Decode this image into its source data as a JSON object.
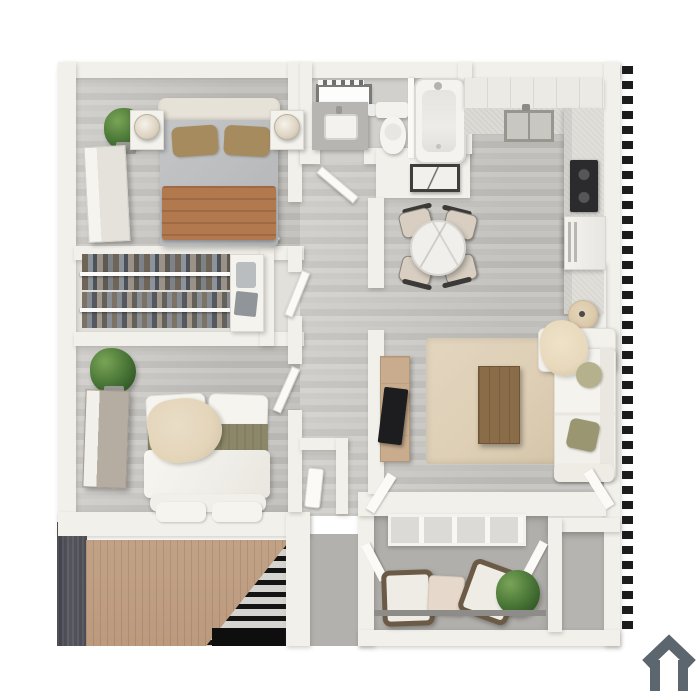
{
  "scene": {
    "kind": "3d-floorplan-top-down-render",
    "canvas": {
      "width": 700,
      "height": 700
    },
    "rooms": [
      {
        "name": "bedroom-1",
        "contents": [
          "queen-bed",
          "nightstand-left",
          "nightstand-right",
          "table-lamp-left",
          "table-lamp-right",
          "dresser",
          "potted-plant"
        ]
      },
      {
        "name": "walk-in-closet",
        "contents": [
          "hanging-clothes-rail-top",
          "hanging-clothes-rail-bottom",
          "linen-cabinet"
        ]
      },
      {
        "name": "bedroom-2",
        "contents": [
          "queen-bed",
          "dresser",
          "potted-plant",
          "foot-bench"
        ]
      },
      {
        "name": "bathroom",
        "contents": [
          "vanity-mirror-lights",
          "vanity-sink",
          "toilet",
          "bathtub-shower"
        ]
      },
      {
        "name": "kitchen",
        "contents": [
          "upper-cabinets",
          "kitchen-sink",
          "cooktop",
          "refrigerator",
          "counters"
        ]
      },
      {
        "name": "dining-area",
        "contents": [
          "round-marble-table",
          "dining-chair x4",
          "wall-art",
          "floor-lamp"
        ]
      },
      {
        "name": "living-room",
        "contents": [
          "area-rug",
          "coffee-table",
          "tv-console",
          "tv",
          "sectional-sofa",
          "throw-blanket",
          "pillows"
        ]
      },
      {
        "name": "hallway",
        "contents": [
          "entry-closet",
          "doors"
        ]
      },
      {
        "name": "patio",
        "contents": [
          "sliding-glass-door",
          "patio-chair x2",
          "side-table",
          "bush-plant"
        ]
      },
      {
        "name": "storage-room",
        "contents": []
      },
      {
        "name": "exterior",
        "contents": [
          "staircase",
          "hatch-marks-left",
          "hatch-marks-right"
        ]
      }
    ]
  },
  "palette": {
    "wall": "#f2f0ea",
    "wall-shade": "#dedad2",
    "floor-base": "#c7c5c1",
    "closet-floor": "#e2e0db",
    "bath-floor": "#d2d0cc",
    "patio-floor": "#b1afab",
    "storage-floor": "#b6b4b0",
    "landing-floor": "#b3b1ad",
    "rug": "#decfb6",
    "coffee-table-wood": "#8b6c48",
    "console-wood": "#c9ac8e",
    "blanket-brown": "#b3794e",
    "pillow-tan": "#a68b5f",
    "sheet-gray": "#bcbec0",
    "olive-runner": "#8c8768",
    "pillow-sage": "#b5b18c",
    "pillow-olive": "#9a9671",
    "throw-beige": "#e4d5b9",
    "plant-green": "#4e7b3a",
    "stairs-wood": "#c2a287",
    "stairs-dark": "#4b4b53",
    "hatch-dark": "#1b1b1d",
    "appliance-dark": "#2b2b2d",
    "white-furniture": "#f3f1ec",
    "counter-gray": "#b7b5b1",
    "glass": "#dcdad6",
    "marble": "#f1efeb",
    "logo-gray": "#5c666f"
  },
  "logo": {
    "icon": "house-outline-icon"
  }
}
